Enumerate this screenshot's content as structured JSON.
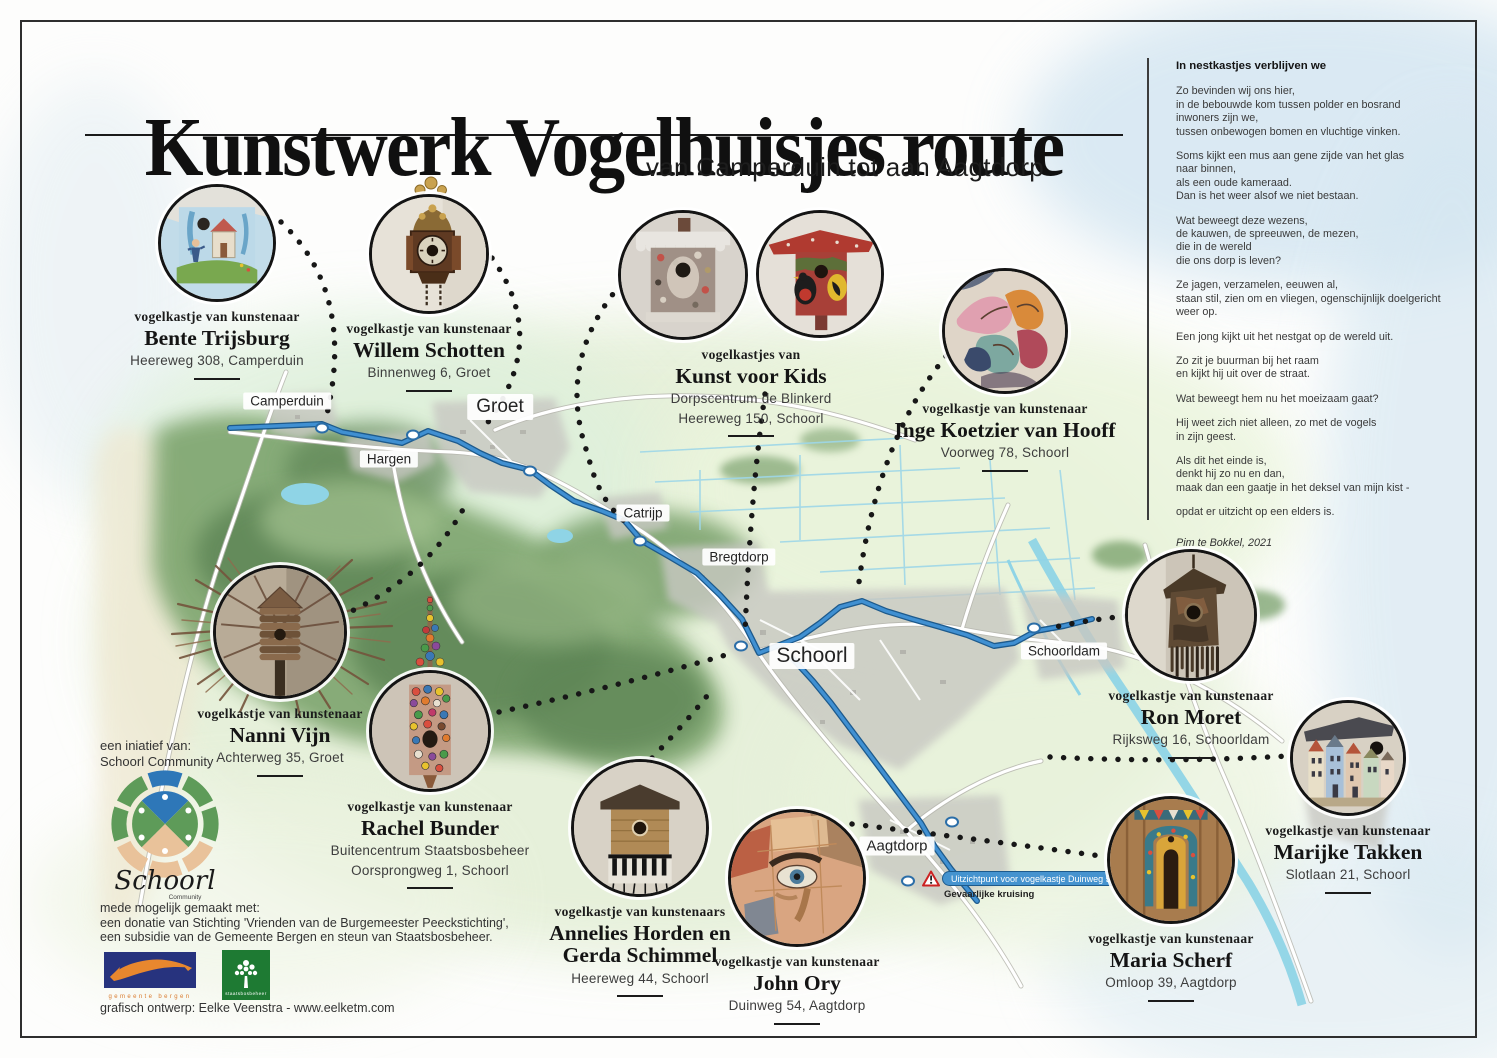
{
  "poster": {
    "title": "Kunstwerk Vogelhuisjes route",
    "subtitle": "van Camperduin tot aan Aagtdorp"
  },
  "poem": {
    "title": "In nestkastjes verblijven we",
    "stanzas": [
      "Zo bevinden wij ons hier,\nin de bebouwde kom tussen polder en bosrand\ninwoners zijn we,\ntussen onbewogen bomen en vluchtige vinken.",
      "Soms kijkt een mus aan gene zijde van het glas\nnaar binnen,\nals een oude kameraad.\nDan is het weer alsof we niet bestaan.",
      "Wat beweegt deze wezens,\nde kauwen, de spreeuwen, de mezen,\ndie in de wereld\ndie ons dorp is leven?",
      "Ze jagen, verzamelen, eeuwen al,\nstaan stil, zien om en vliegen, ogenschijnlijk doelgericht\nweer op.",
      "Een jong kijkt uit het nestgat op de wereld uit.",
      "Zo zit je buurman bij het raam\nen kijkt hij uit over de straat.",
      "Wat beweegt hem nu het moeizaam gaat?",
      "Hij weet zich niet alleen, zo met de vogels\nin zijn geest.",
      "Als dit het einde is,\ndenkt hij zo nu en dan,\nmaak dan een gaatje in het deksel van mijn kist -",
      "opdat er uitzicht op een elders is."
    ],
    "author": "Pim te Bokkel, 2021"
  },
  "entries": [
    {
      "label": "vogelkastje van kunstenaar",
      "name": "Bente Trijsburg",
      "address1": "Heereweg 308, Camperduin"
    },
    {
      "label": "vogelkastje van kunstenaar",
      "name": "Willem Schotten",
      "address1": "Binnenweg 6, Groet"
    },
    {
      "label": "vogelkastjes van",
      "name": "Kunst voor Kids",
      "address1": "Dorpscentrum de Blinkerd",
      "address2": "Heereweg 150, Schoorl"
    },
    {
      "label": "vogelkastje van kunstenaar",
      "name": "Inge Koetzier van Hooff",
      "address1": "Voorweg 78, Schoorl"
    },
    {
      "label": "vogelkastje van kunstenaar",
      "name": "Nanni Vijn",
      "address1": "Achterweg 35, Groet"
    },
    {
      "label": "vogelkastje van kunstenaar",
      "name": "Rachel Bunder",
      "address1": "Buitencentrum Staatsbosbeheer",
      "address2": "Oorsprongweg 1, Schoorl"
    },
    {
      "label": "vogelkastje van kunstenaars",
      "name": "Annelies Horden en Gerda Schimmel",
      "address1": "Heereweg 44, Schoorl"
    },
    {
      "label": "vogelkastje van kunstenaar",
      "name": "John Ory",
      "address1": "Duinweg 54, Aagtdorp"
    },
    {
      "label": "vogelkastje van kunstenaar",
      "name": "Maria Scherf",
      "address1": "Omloop 39, Aagtdorp"
    },
    {
      "label": "vogelkastje van kunstenaar",
      "name": "Ron Moret",
      "address1": "Rijksweg 16, Schoorldam"
    },
    {
      "label": "vogelkastje van kunstenaar",
      "name": "Marijke Takken",
      "address1": "Slotlaan 21, Schoorl"
    }
  ],
  "map": {
    "labels": {
      "camperduin": "Camperduin",
      "hargen": "Hargen",
      "groet": "Groet",
      "catrijp": "Catrijp",
      "bregtdorp": "Bregtdorp",
      "schoorl": "Schoorl",
      "schoorldam": "Schoorldam",
      "aagtdorp": "Aagtdorp"
    },
    "viewpoint_label": "Uitzichtpunt voor vogelkastje Duinweg 54",
    "warning_label": "Gevaarlijke kruising",
    "route_color": "#3d8ed6"
  },
  "footer": {
    "initiative_label": "een iniatief van:",
    "initiative_name": "Schoorl Community",
    "community_logo_title": "Schoorl",
    "community_logo_subtitle": "Community",
    "support_intro": "mede mogelijk gemaakt met:",
    "support_line1": "een donatie van Stichting 'Vrienden van de Burgemeester Peeckstichting',",
    "support_line2": "een subsidie van de Gemeente Bergen en steun van Staatsbosbeheer.",
    "gemeente_logo_text": "gemeente bergen",
    "staatsbosbeheer_logo_text": "staatsbosbeheer",
    "design_credit": "grafisch ontwerp: Eelke Veenstra - www.eelketm.com"
  }
}
